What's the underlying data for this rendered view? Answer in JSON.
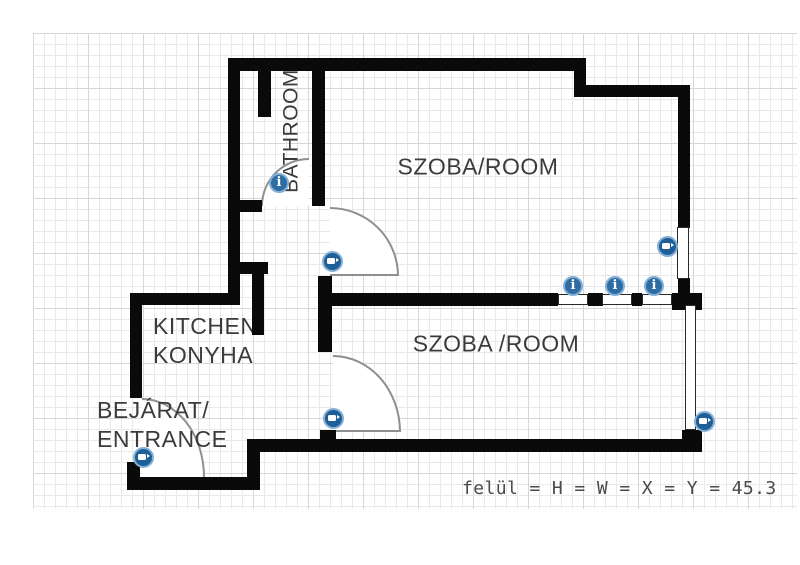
{
  "footer": {
    "status_text": "felül = H = W = X = Y = 45.3"
  },
  "rooms": [
    {
      "id": "bathroom",
      "label": "BATHROOM",
      "x": 291,
      "y": 131,
      "align": "center",
      "rotate": -90
    },
    {
      "id": "room-upper",
      "label": "SZOBA/ROOM",
      "x": 478,
      "y": 167,
      "align": "center"
    },
    {
      "id": "room-lower",
      "label": "SZOBA /ROOM",
      "x": 496,
      "y": 344,
      "align": "center"
    },
    {
      "id": "kitchen",
      "lines": [
        "KITCHEN/",
        "KONYHA"
      ],
      "x": 153,
      "y": 312,
      "align": "left"
    },
    {
      "id": "entrance",
      "lines": [
        "BEJÁRAT/",
        "ENTRANCE"
      ],
      "x": 97,
      "y": 396,
      "align": "left"
    }
  ],
  "plan": {
    "grid": {
      "x": 33,
      "y": 33,
      "width": 764,
      "height": 476
    },
    "walls": [
      [
        228,
        58,
        350,
        13
      ],
      [
        574,
        58,
        12,
        39
      ],
      [
        574,
        85,
        116,
        12
      ],
      [
        678,
        85,
        12,
        143
      ],
      [
        678,
        278,
        12,
        20
      ],
      [
        672,
        293,
        30,
        17
      ],
      [
        318,
        293,
        240,
        13
      ],
      [
        588,
        293,
        15,
        13
      ],
      [
        632,
        293,
        10,
        13
      ],
      [
        312,
        58,
        13,
        148
      ],
      [
        318,
        276,
        14,
        76
      ],
      [
        320,
        430,
        16,
        12
      ],
      [
        248,
        439,
        452,
        13
      ],
      [
        682,
        430,
        20,
        22
      ],
      [
        258,
        58,
        13,
        59
      ],
      [
        228,
        200,
        34,
        12
      ],
      [
        228,
        58,
        12,
        247
      ],
      [
        130,
        293,
        110,
        12
      ],
      [
        130,
        293,
        12,
        105
      ],
      [
        230,
        262,
        38,
        12
      ],
      [
        252,
        274,
        12,
        61
      ],
      [
        127,
        462,
        13,
        28
      ],
      [
        127,
        477,
        126,
        13
      ],
      [
        247,
        439,
        13,
        51
      ]
    ],
    "windows": [
      [
        677,
        227,
        12,
        52
      ],
      [
        685,
        305,
        11,
        125
      ],
      [
        558,
        294,
        30,
        11
      ],
      [
        602,
        294,
        30,
        11
      ],
      [
        642,
        294,
        30,
        11
      ]
    ],
    "doors": [
      {
        "x": 261,
        "y": 158,
        "w": 48,
        "h": 48,
        "corner": "tl",
        "sides": "top,left"
      },
      {
        "x": 330,
        "y": 207,
        "w": 69,
        "h": 69,
        "corner": "tr",
        "sides": "top,right,bottom"
      },
      {
        "x": 333,
        "y": 355,
        "w": 68,
        "h": 77,
        "corner": "tr",
        "sides": "top,right,bottom"
      },
      {
        "x": 142,
        "y": 398,
        "w": 63,
        "h": 79,
        "corner": "tr",
        "sides": "top,right"
      }
    ],
    "icons": [
      {
        "type": "info",
        "x": 279,
        "y": 183
      },
      {
        "type": "info",
        "x": 573,
        "y": 286
      },
      {
        "type": "info",
        "x": 615,
        "y": 286
      },
      {
        "type": "info",
        "x": 654,
        "y": 286
      },
      {
        "type": "camera",
        "x": 332,
        "y": 261
      },
      {
        "type": "camera",
        "x": 667,
        "y": 246
      },
      {
        "type": "camera",
        "x": 333,
        "y": 418
      },
      {
        "type": "camera",
        "x": 143,
        "y": 457
      },
      {
        "type": "camera",
        "x": 704,
        "y": 421
      }
    ]
  },
  "icon_meta": {
    "info_glyph": "i"
  },
  "colors": {
    "wall": "#0a0a0a",
    "window_border": "#2a2a2a",
    "door_arc": "#8f8f8f",
    "label": "#3b3b3b",
    "grid_minor": "#e9e9e9",
    "grid_major": "#d7d7d7",
    "info_icon": "#2e6da4",
    "camera_icon": "#1f5f98",
    "icon_ring": "#85b0d6",
    "footer_text": "#4a4a4a"
  }
}
